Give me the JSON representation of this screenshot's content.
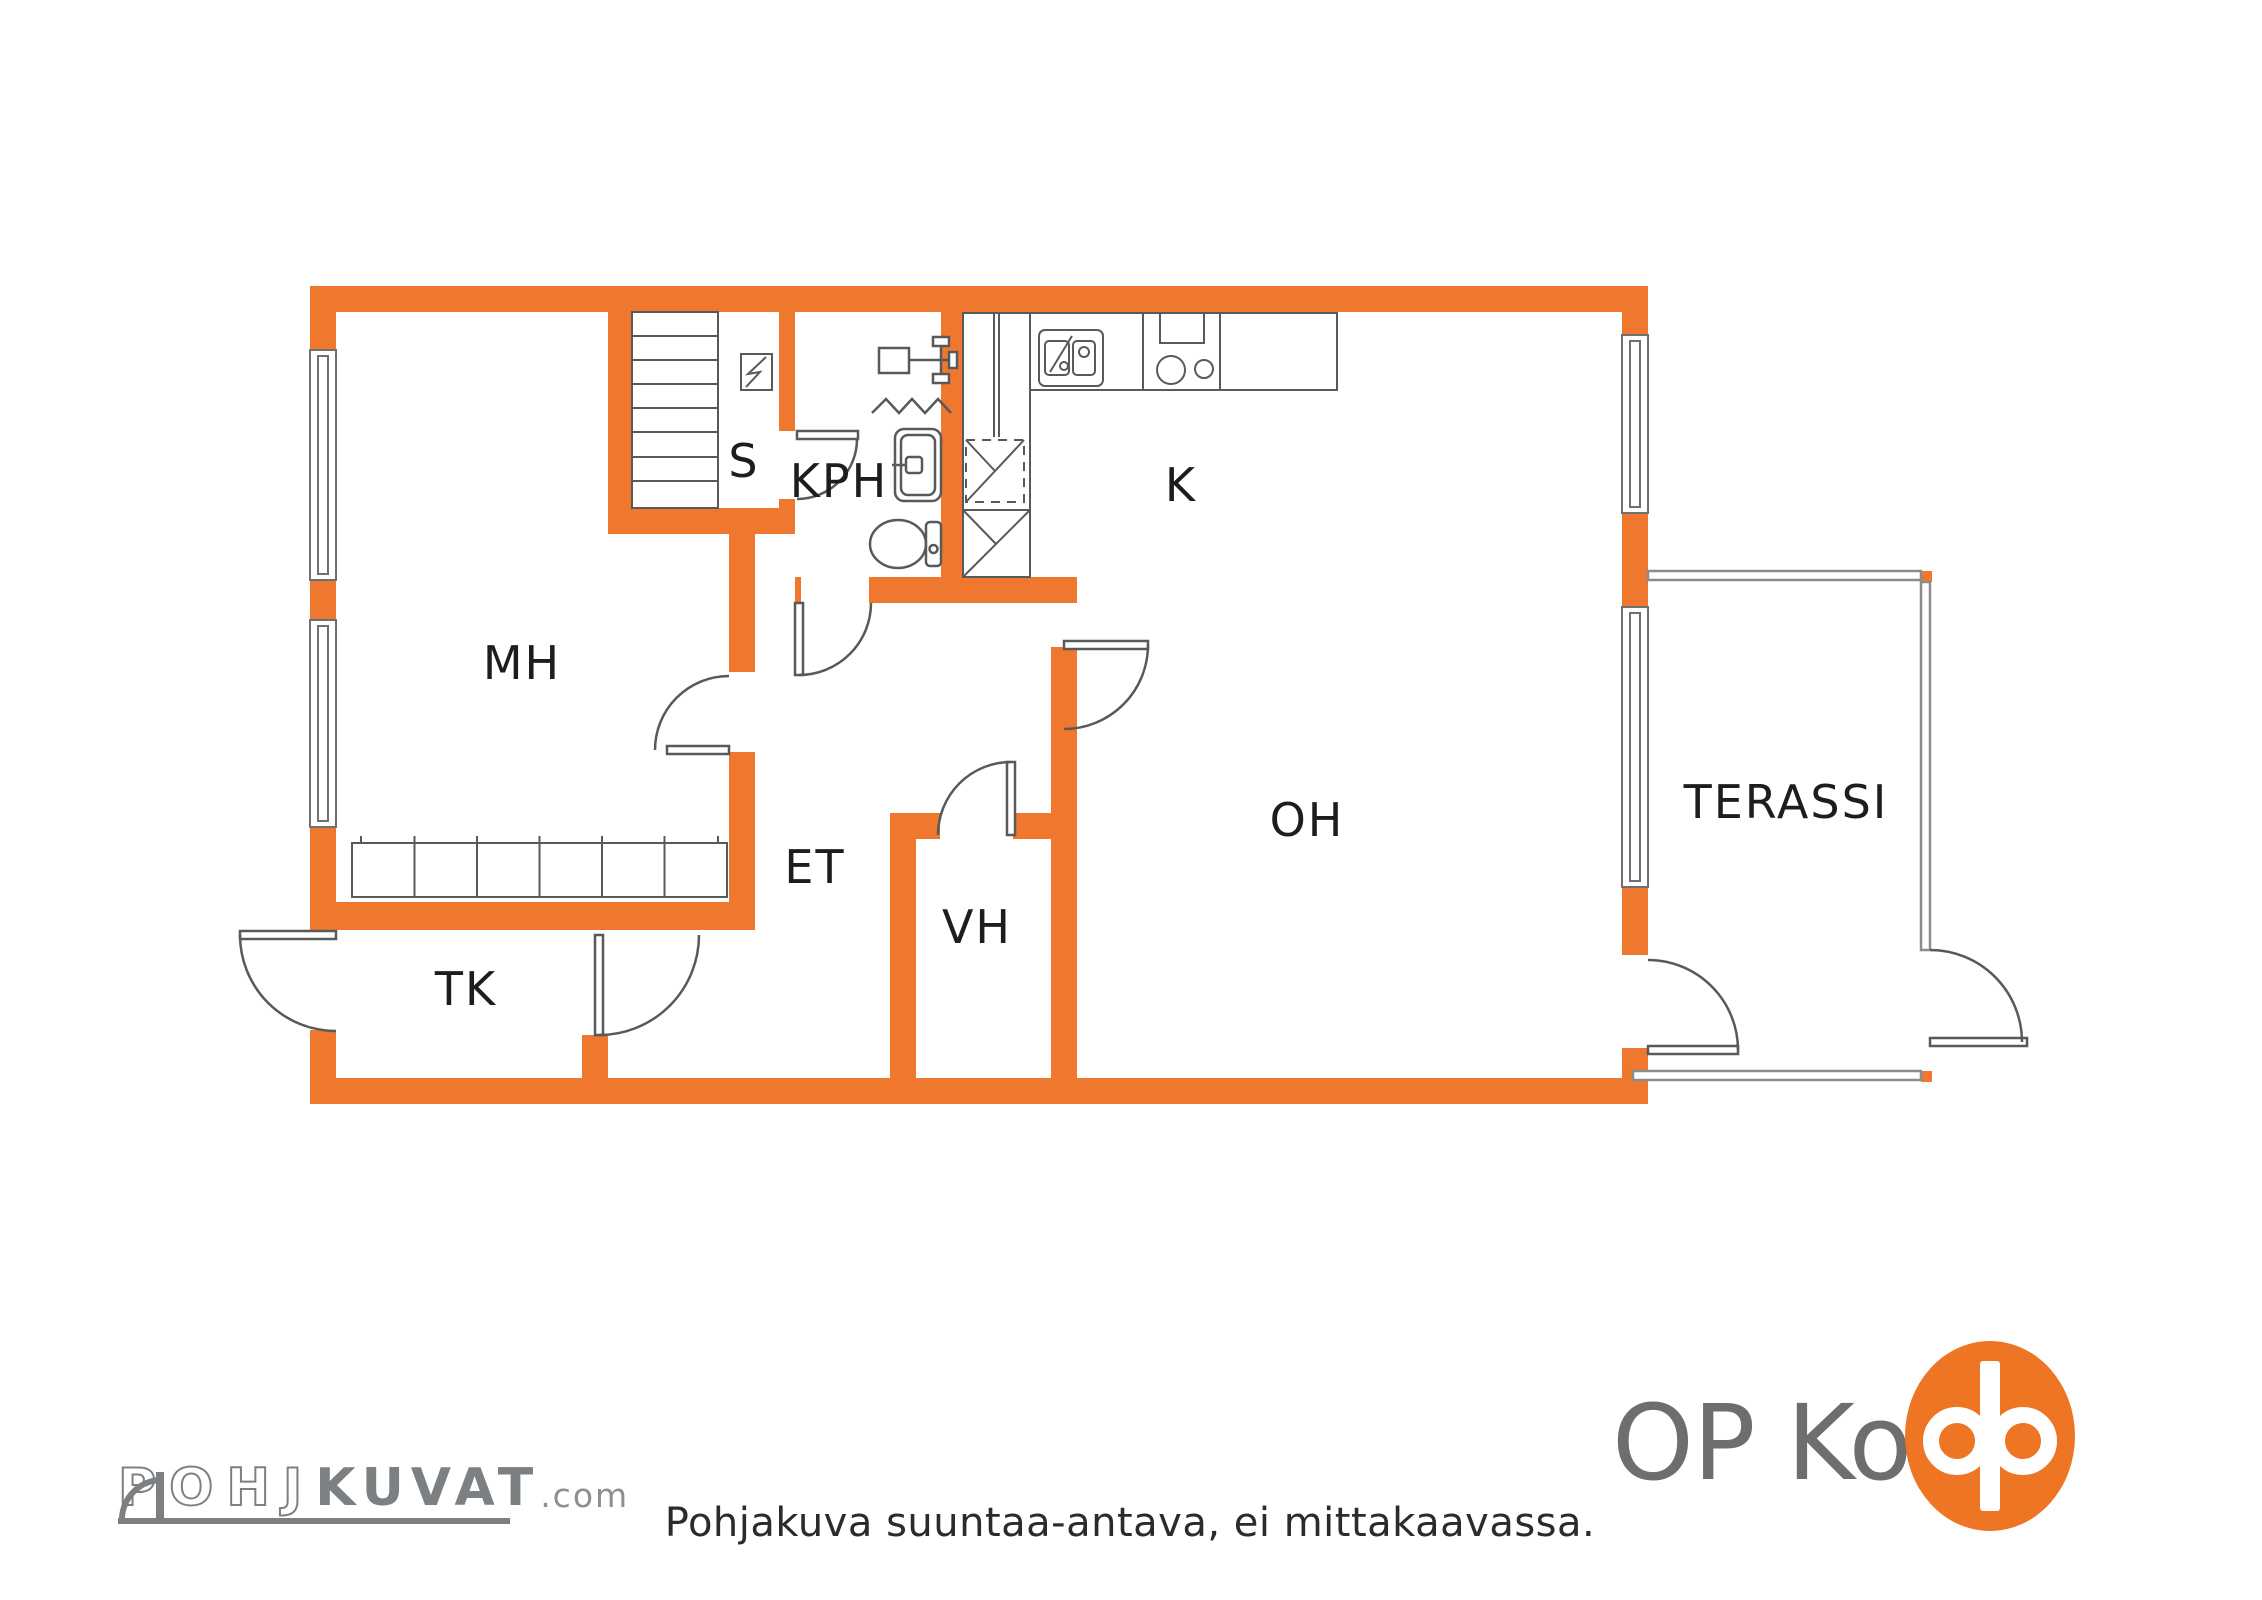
{
  "title": "Floor plan (pohjakuva)",
  "colors": {
    "wall_orange": "#F0782E",
    "fixture_gray": "#58595b",
    "thin_wall_gray": "#8a8c8e",
    "label_black": "#1d1d1b",
    "logo_gray": "#7d8083",
    "op_text_gray": "#6d6e70",
    "op_orange": "#EE7523"
  },
  "rooms": [
    {
      "label": "MH"
    },
    {
      "label": "S"
    },
    {
      "label": "KPH"
    },
    {
      "label": "K"
    },
    {
      "label": "OH"
    },
    {
      "label": "ET"
    },
    {
      "label": "VH"
    },
    {
      "label": "TK"
    },
    {
      "label": "TERASSI"
    }
  ],
  "icons": {
    "stairs": "stairs-icon",
    "wardrobe": "wardrobe-icon",
    "electrical_panel": "lightning-square-icon",
    "shower_mixer": "shower-mixer-icon",
    "shower_zigzag": "zigzag-icon",
    "bathroom_sink": "sink-icon",
    "toilet": "toilet-icon",
    "appliance_upper": "washing-machine-icon",
    "appliance_lower": "dryer-icon",
    "kitchen_sink": "double-sink-icon",
    "stove": "stove-icon",
    "oven": "oven-icon"
  },
  "footer": {
    "disclaimer": "Pohjakuva suuntaa-antava, ei mittakaavassa."
  },
  "branding": {
    "pohjakuvat": {
      "part_outline": "POHJ",
      "part_solid": "KUVAT",
      "suffix": ".com"
    },
    "op_koti": {
      "text": "OP Koti"
    }
  }
}
